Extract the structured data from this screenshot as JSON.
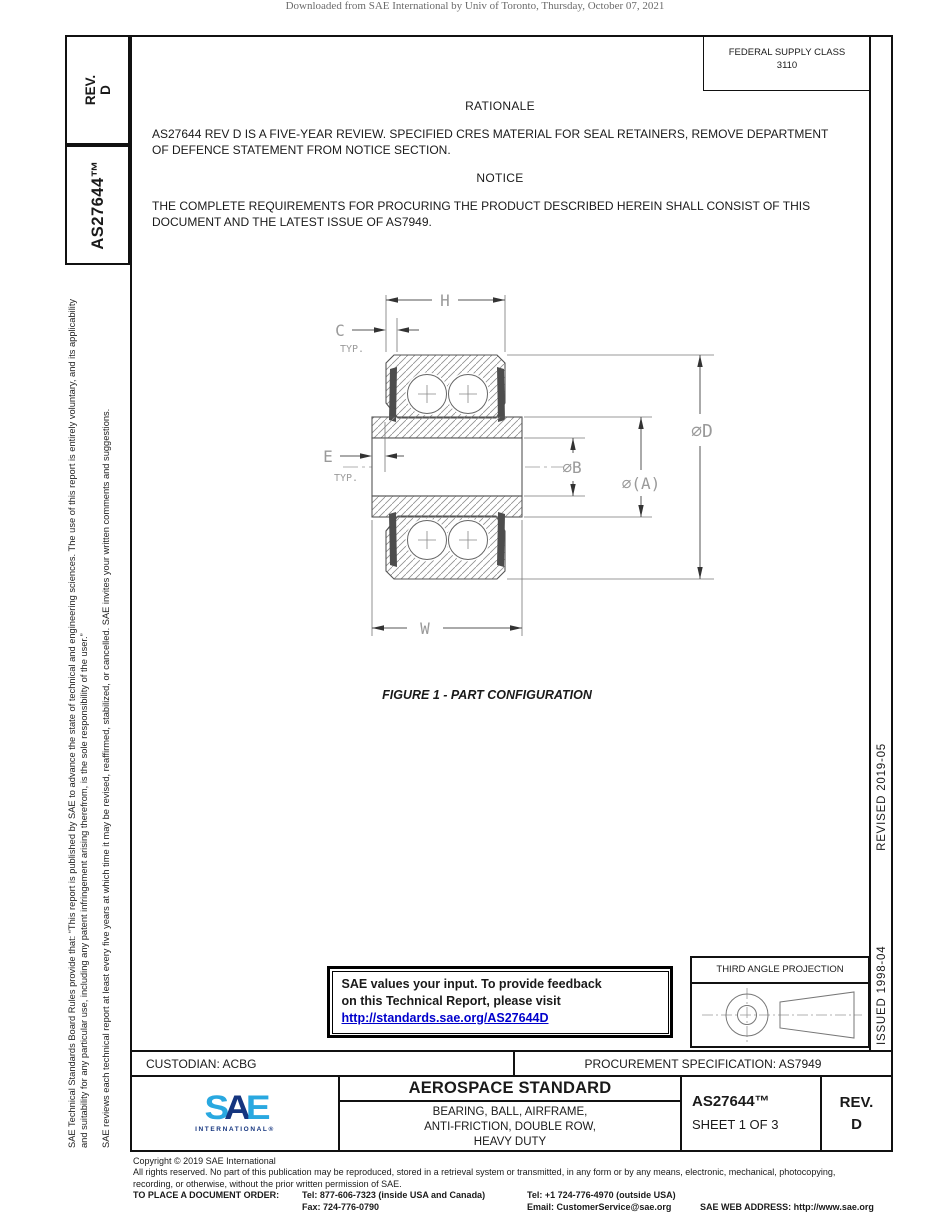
{
  "page": {
    "download_header": "Downloaded from SAE International by Univ of Toronto, Thursday, October 07, 2021"
  },
  "sidebar": {
    "rev_label": "REV.",
    "rev_value": "D",
    "doc_number": "AS27644™",
    "disclaimer_p1": "SAE Technical Standards Board Rules provide that: “This report is published by SAE to advance the state of technical and engineering sciences. The use of this report is entirely voluntary, and its applicability and suitability for any particular use, including any patent infringement arising therefrom, is the sole responsibility of the user.”",
    "disclaimer_p2": "SAE reviews each technical report at least every five years at which time it may be revised, reaffirmed, stabilized, or cancelled. SAE invites your written comments and suggestions."
  },
  "header": {
    "fsc_label": "FEDERAL SUPPLY CLASS",
    "fsc_value": "3110"
  },
  "rationale": {
    "heading": "RATIONALE",
    "body": "AS27644 REV D IS A FIVE-YEAR REVIEW. SPECIFIED CRES MATERIAL FOR SEAL RETAINERS, REMOVE DEPARTMENT OF DEFENCE STATEMENT FROM NOTICE SECTION."
  },
  "notice": {
    "heading": "NOTICE",
    "body": "THE COMPLETE REQUIREMENTS FOR PROCURING THE PRODUCT DESCRIBED HEREIN SHALL CONSIST OF THIS DOCUMENT AND THE LATEST ISSUE OF AS7949."
  },
  "figure": {
    "caption": "FIGURE 1 - PART CONFIGURATION",
    "dim_h": "H",
    "dim_c": "C",
    "dim_e": "E",
    "typ": "TYP.",
    "dia_b": "∅B",
    "dia_a": "∅(A)",
    "dia_d": "∅D",
    "dim_w": "W"
  },
  "feedback_box": {
    "line1": "SAE values your input. To provide feedback",
    "line2": "on this Technical Report, please visit",
    "link": "http://standards.sae.org/AS27644D"
  },
  "projection": {
    "label": "THIRD ANGLE PROJECTION"
  },
  "revision_column": {
    "issued": "ISSUED 1998-04",
    "revised": "REVISED 2019-05"
  },
  "title_block": {
    "custodian": "CUSTODIAN: ACBG",
    "procurement": "PROCUREMENT SPECIFICATION: AS7949",
    "logo_s": "S",
    "logo_a": "A",
    "logo_e": "E",
    "logo_sub": "INTERNATIONAL®",
    "standard_type": "AEROSPACE STANDARD",
    "title_lines": [
      "BEARING, BALL, AIRFRAME,",
      "ANTI-FRICTION, DOUBLE ROW,",
      "HEAVY DUTY"
    ],
    "doc_number": "AS27644™",
    "sheet": "SHEET 1 OF 3",
    "rev_label": "REV.",
    "rev_value": "D"
  },
  "footer": {
    "copyright": "Copyright © 2019 SAE International",
    "rights_line1": "All rights reserved. No part of this publication may be reproduced, stored in a retrieval system or transmitted, in any form or by any means, electronic, mechanical, photocopying,",
    "rights_line2": "recording, or otherwise, without the prior written permission of SAE.",
    "order_label": "TO PLACE A DOCUMENT ORDER:",
    "tel_inside": "Tel: 877-606-7323 (inside USA and Canada)",
    "fax": "Fax: 724-776-0790",
    "tel_outside": "Tel: +1 724-776-4970 (outside USA)",
    "email": "Email: CustomerService@sae.org",
    "web": "SAE WEB ADDRESS: http://www.sae.org"
  },
  "colors": {
    "link_blue": "#0000cc",
    "logo_light_blue": "#29a8e0",
    "logo_dark_blue": "#15357f"
  }
}
